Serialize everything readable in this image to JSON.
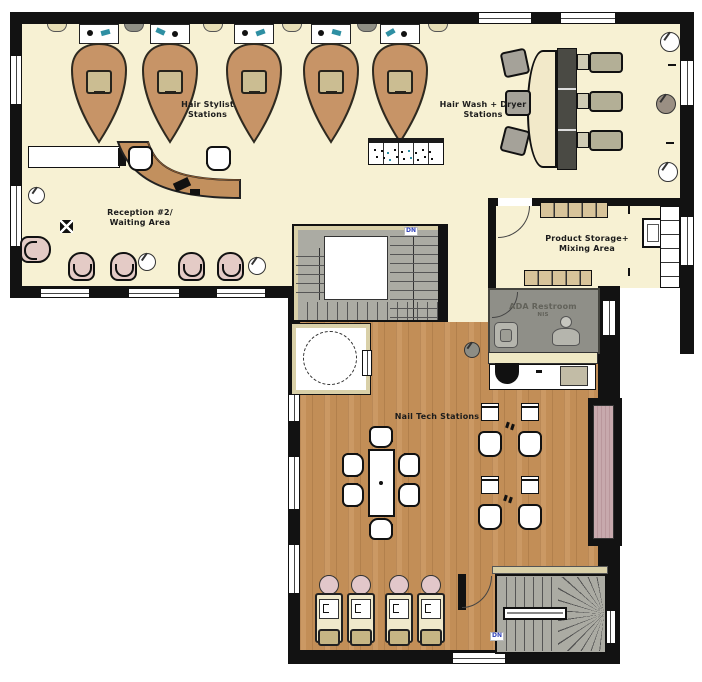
{
  "areas": {
    "hair_stylist": {
      "line1": "Hair Stylist",
      "line2": "Stations"
    },
    "hair_wash": {
      "line1": "Hair Wash + Dryer",
      "line2": "Stations"
    },
    "reception": {
      "line1": "Reception #2/",
      "line2": "Waiting Area"
    },
    "product_storage": {
      "line1": "Product Storage+",
      "line2": "Mixing Area"
    },
    "ada_restroom": {
      "line1": "ADA Restroom",
      "line2": "NIS"
    },
    "nail_tech": {
      "line1": "Nail Tech Stations"
    }
  },
  "stairs": {
    "middle_dn": "DN",
    "lower_dn": "DN"
  },
  "inventory": {
    "hair_stylist_stations": 5,
    "wash_dryer_chairs": 3,
    "waiting_tub_chairs": 5,
    "pedicure_stations": 4,
    "nail_tech_tables": 4,
    "manicure_table_seats": 6
  },
  "icons": {
    "plant": "circle-with-stem",
    "door_swing": "quarter-arc",
    "floor_outlet": "black-square-x",
    "station_tool_dark": "black-dot",
    "station_tool_teal": "teal-nozzle"
  },
  "colors": {
    "floor_cream": "#F7F1D3",
    "floor_wood": "#C8935A",
    "wall_black": "#121212",
    "furniture_tan": "#C79467",
    "desk_tan": "#C2905E",
    "stair_gray": "#ABABA3",
    "restroom_gray": "#8F8F88",
    "waiting_chair_pink": "#E4CBC6",
    "bench_mauve": "#C7A9AD",
    "shelf_tan": "#D8C49A",
    "icon_teal": "#2E8FA3",
    "dn_blue": "#3344BB"
  }
}
